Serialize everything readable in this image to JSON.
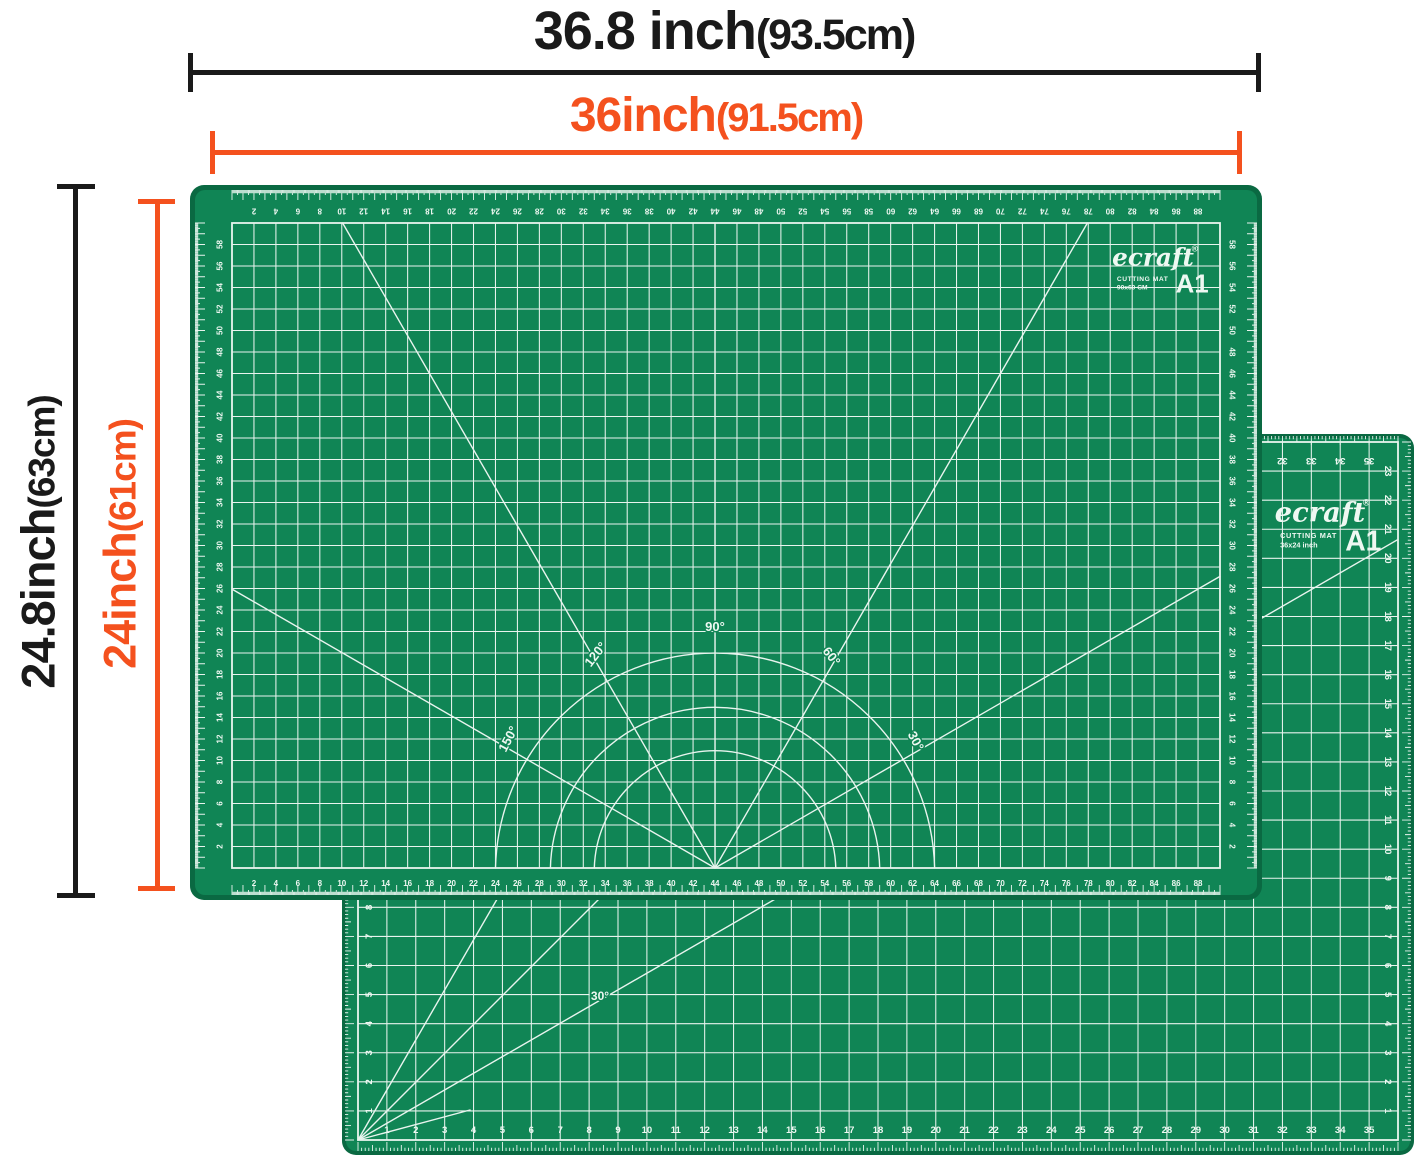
{
  "colors": {
    "mat_green": "#108555",
    "mat_edge": "#0a6942",
    "grid_line": "#e8f4ee",
    "ink": "#1a1a1a",
    "accent_orange": "#f4511e"
  },
  "dims": {
    "outer_width": {
      "value": "36.8 inch",
      "paren": "(93.5cm)"
    },
    "inner_width": {
      "value": "36inch",
      "paren": "(91.5cm)"
    },
    "outer_height": {
      "value": "24.8inch",
      "paren": "(63cm)"
    },
    "inner_height": {
      "value": "24inch",
      "paren": "(61cm)"
    }
  },
  "mat_front": {
    "brand": "ecraft",
    "reg": "®",
    "type_label": "CUTTING MAT",
    "size_text": "90x60 CM",
    "grade": "A1",
    "angle_labels": [
      "90°",
      "120°",
      "60°",
      "150°",
      "30°"
    ],
    "bottom_numbers": [
      2,
      4,
      6,
      8,
      10,
      12,
      14,
      16,
      18,
      20,
      22,
      24,
      26,
      28,
      30,
      32,
      34,
      36,
      38,
      40,
      42,
      44,
      46,
      48,
      50,
      52,
      54,
      56,
      58,
      60,
      62,
      64,
      66,
      68,
      70,
      72,
      74,
      76,
      78,
      80,
      82,
      84,
      86,
      88
    ],
    "side_numbers": [
      2,
      4,
      6,
      8,
      10,
      12,
      14,
      16,
      18,
      20,
      22,
      24,
      26,
      28,
      30,
      32,
      34,
      36,
      38,
      40,
      42,
      44,
      46,
      48,
      50,
      52,
      54,
      56,
      58
    ]
  },
  "mat_back": {
    "brand": "ecraft",
    "reg": "®",
    "type_label": "CUTTING MAT",
    "size_text": "36x24 inch",
    "grade": "A1",
    "angle_label": "30°",
    "bottom_numbers": [
      1,
      2,
      3,
      4,
      5,
      6,
      7,
      8,
      9,
      10,
      11,
      12,
      13,
      14,
      15,
      16,
      17,
      18,
      19,
      20,
      21,
      22,
      23,
      24,
      25,
      26,
      27,
      28,
      29,
      30,
      31,
      32,
      33,
      34,
      35
    ],
    "side_numbers": [
      1,
      2,
      3,
      4,
      5,
      6,
      7,
      8,
      9,
      10,
      11,
      12,
      13,
      14,
      15,
      16,
      17,
      18,
      19,
      20,
      21,
      22,
      23
    ]
  }
}
